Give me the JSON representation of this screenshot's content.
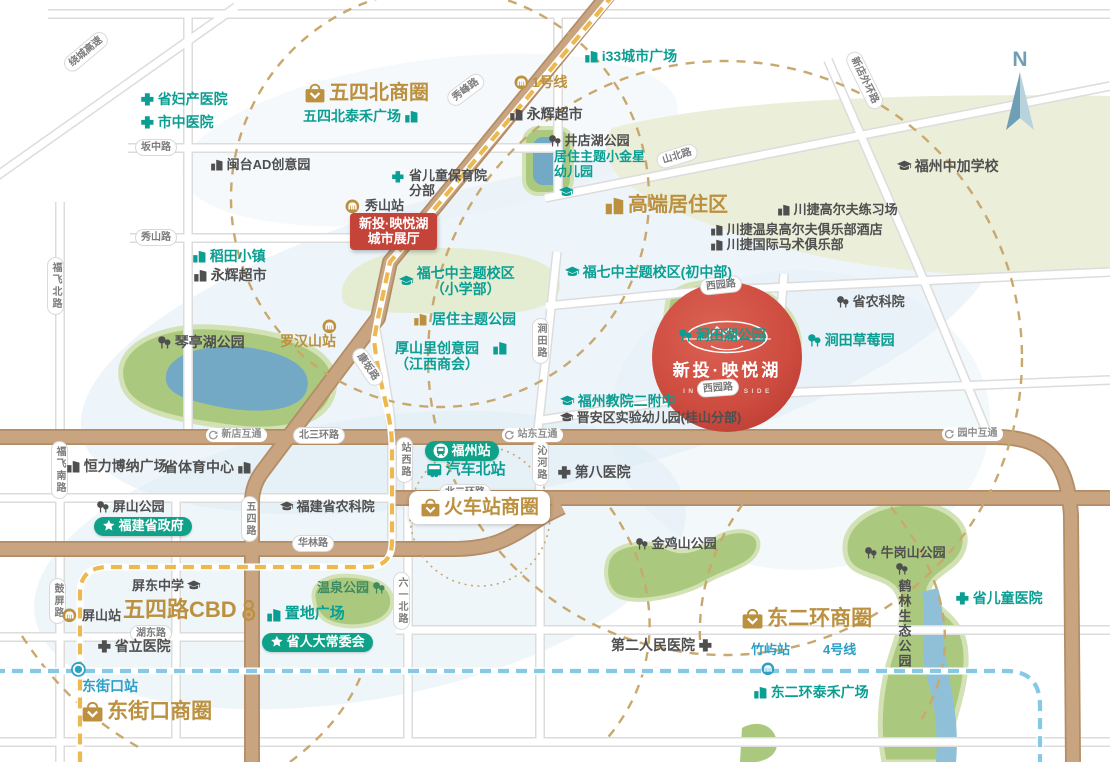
{
  "project": {
    "name": "新投·映悦湖",
    "tagline": "IN CHILL SIDE"
  },
  "special": {
    "compass_n": "N"
  },
  "colors": {
    "teal": "#0b9e92",
    "gold": "#bb9140",
    "dark": "#4f4f4f",
    "blue": "#2d9ec4",
    "line1_gold": "#ecb950",
    "line4_blue": "#85c9e6",
    "road_brown": "#c9a480",
    "park_green": "#abc97e",
    "lake_blue": "#74a9c6",
    "project_red": "#cc4a3e",
    "radius_dash": "#c9a86d",
    "green_pill": "#0fa289",
    "red_box": "#c5443a"
  },
  "labels": [
    {
      "n": "road-label-raocheng-expressway",
      "c": "pill",
      "t": "绕城高速",
      "x": 66,
      "y": 60,
      "r": -40
    },
    {
      "n": "road-label-banzhong",
      "c": "pill",
      "t": "坂中路",
      "x": 135,
      "y": 139
    },
    {
      "n": "road-label-xiushan",
      "c": "pill",
      "t": "秀山路",
      "x": 135,
      "y": 229
    },
    {
      "n": "road-label-xiufeng",
      "c": "pill",
      "t": "秀峰路",
      "x": 449,
      "y": 94,
      "r": -37
    },
    {
      "n": "road-label-shanbei",
      "c": "pill",
      "t": "山北路",
      "x": 657,
      "y": 154,
      "r": -17
    },
    {
      "n": "road-label-xindian-outer-ring",
      "c": "pill",
      "t": "新店外环路",
      "x": 851,
      "y": 44,
      "r": 64
    },
    {
      "n": "road-label-fufei-north",
      "c": "pill",
      "t": "福飞北路",
      "x": 47,
      "y": 257,
      "v": 1
    },
    {
      "n": "road-label-fufei-south",
      "c": "pill",
      "t": "福飞南路",
      "x": 51,
      "y": 441,
      "v": 1
    },
    {
      "n": "road-label-guping",
      "c": "pill",
      "t": "鼓屏路",
      "x": 49,
      "y": 578,
      "v": 1
    },
    {
      "n": "road-label-kangban",
      "c": "pill",
      "t": "康坂路",
      "x": 356,
      "y": 341,
      "r": 56
    },
    {
      "n": "road-label-north-3rd-ring",
      "c": "pill",
      "t": "北三环路",
      "x": 293,
      "y": 427
    },
    {
      "n": "road-label-zhanxi",
      "c": "pill",
      "t": "站西路",
      "x": 396,
      "y": 437,
      "v": 1
    },
    {
      "n": "road-label-qinhe",
      "c": "pill",
      "t": "沁河路",
      "x": 532,
      "y": 440,
      "v": 1
    },
    {
      "n": "road-label-jiantian",
      "c": "pill",
      "t": "涧田路",
      "x": 532,
      "y": 318,
      "v": 1
    },
    {
      "n": "road-label-xiyuan-north",
      "c": "pill",
      "t": "西园路",
      "x": 700,
      "y": 279,
      "r": -6
    },
    {
      "n": "road-label-xiyuan-south",
      "c": "pill",
      "t": "西园路",
      "x": 697,
      "y": 381,
      "r": -4
    },
    {
      "n": "road-label-north-2nd-ring",
      "c": "pill",
      "t": "北二环路",
      "x": 439,
      "y": 484
    },
    {
      "n": "road-label-wusi",
      "c": "pill",
      "t": "五四路",
      "x": 241,
      "y": 496,
      "v": 1
    },
    {
      "n": "road-label-hualin",
      "c": "pill",
      "t": "华林路",
      "x": 292,
      "y": 535
    },
    {
      "n": "road-label-hudong",
      "c": "pill",
      "t": "湖东路",
      "x": 130,
      "y": 625
    },
    {
      "n": "road-label-liuyi-north",
      "c": "pill",
      "t": "六一北路",
      "x": 393,
      "y": 572,
      "v": 1
    },
    {
      "n": "interchange-xindian",
      "c": "inter",
      "i": "inter",
      "t": "新店互通",
      "x": 206,
      "y": 428
    },
    {
      "n": "interchange-zhandong",
      "c": "inter",
      "i": "inter",
      "t": "站东互通",
      "x": 502,
      "y": 428
    },
    {
      "n": "interchange-yuanzhong",
      "c": "inter",
      "i": "inter",
      "t": "园中互通",
      "x": 942,
      "y": 427
    },
    {
      "n": "poi-provincial-maternity-hospital",
      "c": "teal",
      "i": "cross",
      "t": "省妇产医院",
      "x": 140,
      "y": 92,
      "s": 14
    },
    {
      "n": "poi-city-tcm-hospital",
      "c": "teal",
      "i": "cross",
      "t": "市中医院",
      "x": 140,
      "y": 115,
      "s": 14
    },
    {
      "n": "biz-wusibei",
      "c": "gold",
      "i": "bag",
      "t": "五四北商圈",
      "x": 304,
      "y": 82,
      "s": 20
    },
    {
      "n": "poi-wusibei-taihe-plaza",
      "c": "teal",
      "i": "bldg",
      "is": "r",
      "t": "五四北泰禾广场",
      "x": 303,
      "y": 109,
      "s": 14
    },
    {
      "n": "poi-mintai-ad-creative-park",
      "c": "dark",
      "i": "bldg",
      "t": "闽台AD创意园",
      "x": 210,
      "y": 158,
      "s": 13
    },
    {
      "n": "metro-line1-label",
      "c": "gold",
      "i": "metro",
      "t": "1号线",
      "x": 514,
      "y": 75,
      "s": 14
    },
    {
      "n": "poi-i33-city-plaza",
      "c": "teal",
      "i": "bldg",
      "t": "i33城市广场",
      "x": 584,
      "y": 49,
      "s": 14
    },
    {
      "n": "poi-yonghui-market-north",
      "c": "dark",
      "i": "bldg",
      "t": "永辉超市",
      "x": 509,
      "y": 107,
      "s": 14
    },
    {
      "n": "poi-jingdianhu-park",
      "c": "dark",
      "i": "tree",
      "t": "井店湖公园",
      "x": 548,
      "y": 134,
      "s": 13
    },
    {
      "n": "poi-xiaojinxing-kindergarten",
      "c": "teal",
      "t": "居住主题小金星",
      "l2": "幼儿园",
      "x": 554,
      "y": 150,
      "s": 13
    },
    {
      "n": "icon-xiaojinxing-cap",
      "c": "teal",
      "i": "cap",
      "x": 559,
      "y": 185,
      "s": 14
    },
    {
      "n": "poi-fuzhou-sino-canada-school",
      "c": "dark",
      "i": "cap",
      "t": "福州中加学校",
      "x": 897,
      "y": 159,
      "s": 14
    },
    {
      "n": "area-highend-residential",
      "c": "gold",
      "i": "bldg",
      "t": "高端居住区",
      "x": 604,
      "y": 194,
      "s": 20
    },
    {
      "n": "poi-chuanjie-golf-range",
      "c": "dark",
      "i": "bldg",
      "t": "川捷高尔夫练习场",
      "x": 777,
      "y": 203,
      "s": 13
    },
    {
      "n": "poi-chuanjie-hotspring-golf-hotel",
      "c": "dark",
      "i": "bldg",
      "t": "川捷温泉高尔夫俱乐部酒店",
      "x": 710,
      "y": 223,
      "s": 13
    },
    {
      "n": "poi-chuanjie-equestrian-club",
      "c": "dark",
      "i": "bldg",
      "t": "川捷国际马术俱乐部",
      "x": 710,
      "y": 238,
      "s": 13
    },
    {
      "n": "icon-baoyuyuan-cross",
      "c": "teal",
      "i": "cross",
      "x": 391,
      "y": 170,
      "s": 13
    },
    {
      "n": "poi-children-care-institute",
      "c": "dark",
      "t": "省儿童保育院",
      "l2": "分部",
      "x": 409,
      "y": 169,
      "s": 13
    },
    {
      "n": "icon-xiushan-station-metro",
      "c": "gold",
      "i": "metro",
      "x": 345,
      "y": 199,
      "s": 14
    },
    {
      "n": "station-xiushan",
      "c": "dark",
      "t": "秀山站",
      "x": 365,
      "y": 199,
      "s": 13
    },
    {
      "n": "showroom-box",
      "c": "redbox",
      "t": "新投·映悦湖",
      "l2": "城市展厅",
      "x": 350,
      "y": 213,
      "s": 13
    },
    {
      "n": "poi-daotian-town",
      "c": "teal",
      "i": "bldg",
      "t": "稻田小镇",
      "x": 192,
      "y": 249,
      "s": 14
    },
    {
      "n": "poi-yonghui-market-west",
      "c": "dark",
      "i": "bldg",
      "t": "永辉超市",
      "x": 193,
      "y": 268,
      "s": 14
    },
    {
      "n": "school-fuqizhong-primary",
      "c": "teal",
      "i": "cap",
      "t": "福七中主题校区",
      "l2": "（小学部）",
      "l2c": 1,
      "x": 399,
      "y": 266,
      "s": 14
    },
    {
      "n": "school-fuqizhong-junior",
      "c": "teal",
      "i": "cap",
      "t": "福七中主题校区(初中部)",
      "x": 565,
      "y": 265,
      "s": 14
    },
    {
      "n": "icon-juzhu-theme-park",
      "c": "gold",
      "i": "bldg",
      "x": 413,
      "y": 312,
      "s": 14
    },
    {
      "n": "poi-juzhu-theme-park",
      "c": "teal",
      "t": "居住主题公园",
      "x": 432,
      "y": 312,
      "s": 14
    },
    {
      "n": "poi-houshanli-creative-park",
      "c": "teal",
      "t": "厚山里创意园",
      "l2": "（江西商会）",
      "x": 395,
      "y": 341,
      "s": 14
    },
    {
      "n": "icon-houshanli-bldg",
      "c": "teal",
      "i": "bldg",
      "x": 492,
      "y": 340,
      "s": 15
    },
    {
      "n": "station-luohanshan",
      "c": "gold",
      "t": "罗汉山站",
      "x": 280,
      "y": 334,
      "s": 14
    },
    {
      "n": "icon-luohanshan-metro",
      "c": "gold",
      "i": "metro",
      "x": 322,
      "y": 319,
      "s": 14
    },
    {
      "n": "poi-qintinghu-park",
      "c": "dark",
      "i": "tree",
      "t": "琴亭湖公园",
      "x": 157,
      "y": 335,
      "s": 14
    },
    {
      "n": "poi-jiantianhu-park",
      "c": "teal",
      "i": "tree",
      "t": "涧田湖公园",
      "x": 678,
      "y": 328,
      "s": 14
    },
    {
      "n": "poi-jiantian-strawberry-farm",
      "c": "teal",
      "i": "tree",
      "t": "涧田草莓园",
      "x": 807,
      "y": 333,
      "s": 14
    },
    {
      "n": "poi-prov-agri-academy",
      "c": "dark",
      "i": "tree",
      "t": "省农科院",
      "x": 836,
      "y": 295,
      "s": 13
    },
    {
      "n": "school-fujiaoyuan-erfuzhong",
      "c": "teal",
      "i": "cap",
      "t": "福州教院二附中",
      "x": 560,
      "y": 394,
      "s": 14
    },
    {
      "n": "school-jinan-exp-kindergarten",
      "c": "dark",
      "i": "cap",
      "t": "晋安区实验幼儿园(桂山分部)",
      "x": 560,
      "y": 411,
      "s": 13
    },
    {
      "n": "poi-hengli-bona-plaza",
      "c": "dark",
      "i": "bldg",
      "t": "恒力博纳广场",
      "x": 66,
      "y": 459,
      "s": 14
    },
    {
      "n": "poi-prov-sports-center",
      "c": "dark",
      "i": "bldg",
      "is": "r",
      "t": "省体育中心",
      "x": 164,
      "y": 460,
      "s": 14
    },
    {
      "n": "station-fuzhou-railway",
      "c": "greenpill",
      "i": "train",
      "t": "福州站",
      "x": 425,
      "y": 441,
      "s": 13
    },
    {
      "n": "station-north-bus",
      "c": "teal",
      "i": "bus",
      "t": "汽车北站",
      "x": 426,
      "y": 462,
      "s": 15
    },
    {
      "n": "poi-no8-hospital",
      "c": "dark",
      "i": "cross",
      "t": "第八医院",
      "x": 557,
      "y": 465,
      "s": 14
    },
    {
      "n": "school-fujian-agri-academy",
      "c": "dark",
      "i": "cap",
      "t": "福建省农科院",
      "x": 280,
      "y": 500,
      "s": 13
    },
    {
      "n": "poi-pingshan-park",
      "c": "dark",
      "i": "tree",
      "t": "屏山公园",
      "x": 96,
      "y": 500,
      "s": 13
    },
    {
      "n": "gov-fujian-provincial",
      "c": "greenpill",
      "i": "star",
      "t": "福建省政府",
      "x": 94,
      "y": 517,
      "s": 13
    },
    {
      "n": "biz-railway-station",
      "c": "sqbox",
      "i": "bag",
      "t": "火车站商圈",
      "x": 409,
      "y": 491,
      "s": 19
    },
    {
      "n": "poi-jinjishan-park",
      "c": "dark",
      "i": "tree",
      "t": "金鸡山公园",
      "x": 635,
      "y": 537,
      "s": 13
    },
    {
      "n": "school-pingdong",
      "c": "dark",
      "i": "cap",
      "is": "r",
      "t": "屏东中学",
      "x": 132,
      "y": 579,
      "s": 13
    },
    {
      "n": "biz-wusilu-cbd",
      "c": "gold",
      "i": "cbd",
      "is": "r",
      "t": "五四路CBD",
      "x": 123,
      "y": 598,
      "s": 22
    },
    {
      "n": "icon-pingshan-station-metro",
      "c": "gold",
      "i": "metro",
      "x": 62,
      "y": 608,
      "s": 14
    },
    {
      "n": "station-pingshan",
      "c": "dark",
      "t": "屏山站",
      "x": 82,
      "y": 609,
      "s": 13
    },
    {
      "n": "poi-wenquan-park",
      "c": "green",
      "i": "tree",
      "is": "r",
      "t": "温泉公园",
      "x": 317,
      "y": 581,
      "s": 13
    },
    {
      "n": "poi-zhidi-plaza",
      "c": "teal",
      "i": "bldg",
      "t": "置地广场",
      "x": 266,
      "y": 606,
      "s": 15
    },
    {
      "n": "gov-prov-peoples-congress",
      "c": "greenpill",
      "i": "star",
      "t": "省人大常委会",
      "x": 262,
      "y": 633,
      "s": 13
    },
    {
      "n": "poi-shengli-hospital",
      "c": "dark",
      "i": "cross",
      "t": "省立医院",
      "x": 97,
      "y": 639,
      "s": 14
    },
    {
      "n": "icon-dongjiekou-junction",
      "c": "blue",
      "i": "junction",
      "x": 70,
      "y": 661,
      "s": 16
    },
    {
      "n": "station-dongjiekou",
      "c": "blue",
      "t": "东街口站",
      "x": 82,
      "y": 679,
      "s": 14
    },
    {
      "n": "biz-dongjiekou",
      "c": "gold",
      "i": "bag",
      "t": "东街口商圈",
      "x": 81,
      "y": 700,
      "s": 21
    },
    {
      "n": "poi-no2-peoples-hospital",
      "c": "dark",
      "i": "cross",
      "is": "r",
      "t": "第二人民医院",
      "x": 611,
      "y": 638,
      "s": 14
    },
    {
      "n": "biz-dongerhuan",
      "c": "gold",
      "i": "bag",
      "t": "东二环商圈",
      "x": 741,
      "y": 607,
      "s": 21
    },
    {
      "n": "station-zhuyu",
      "c": "blue",
      "t": "竹屿站",
      "x": 751,
      "y": 643,
      "s": 13
    },
    {
      "n": "metro-line4-label",
      "c": "blue",
      "t": "4号线",
      "x": 823,
      "y": 643,
      "s": 13
    },
    {
      "n": "icon-zhuyu-station-metro",
      "c": "blue",
      "i": "metro",
      "x": 761,
      "y": 662,
      "s": 13
    },
    {
      "n": "poi-dongerhuan-taihe-plaza",
      "c": "teal",
      "i": "bldg",
      "t": "东二环泰禾广场",
      "x": 753,
      "y": 685,
      "s": 14
    },
    {
      "n": "poi-niugangshan-park",
      "c": "dark",
      "i": "tree",
      "t": "牛岗山公园",
      "x": 864,
      "y": 546,
      "s": 13
    },
    {
      "n": "icon-helin-tree",
      "c": "dark",
      "i": "tree",
      "x": 895,
      "y": 562,
      "s": 13
    },
    {
      "n": "poi-helin-eco-park",
      "c": "dark",
      "t": "鹤林生态公园",
      "x": 896,
      "y": 579,
      "s": 13,
      "v": 1
    },
    {
      "n": "poi-prov-children-hospital",
      "c": "teal",
      "i": "cross",
      "t": "省儿童医院",
      "x": 955,
      "y": 591,
      "s": 14
    }
  ]
}
